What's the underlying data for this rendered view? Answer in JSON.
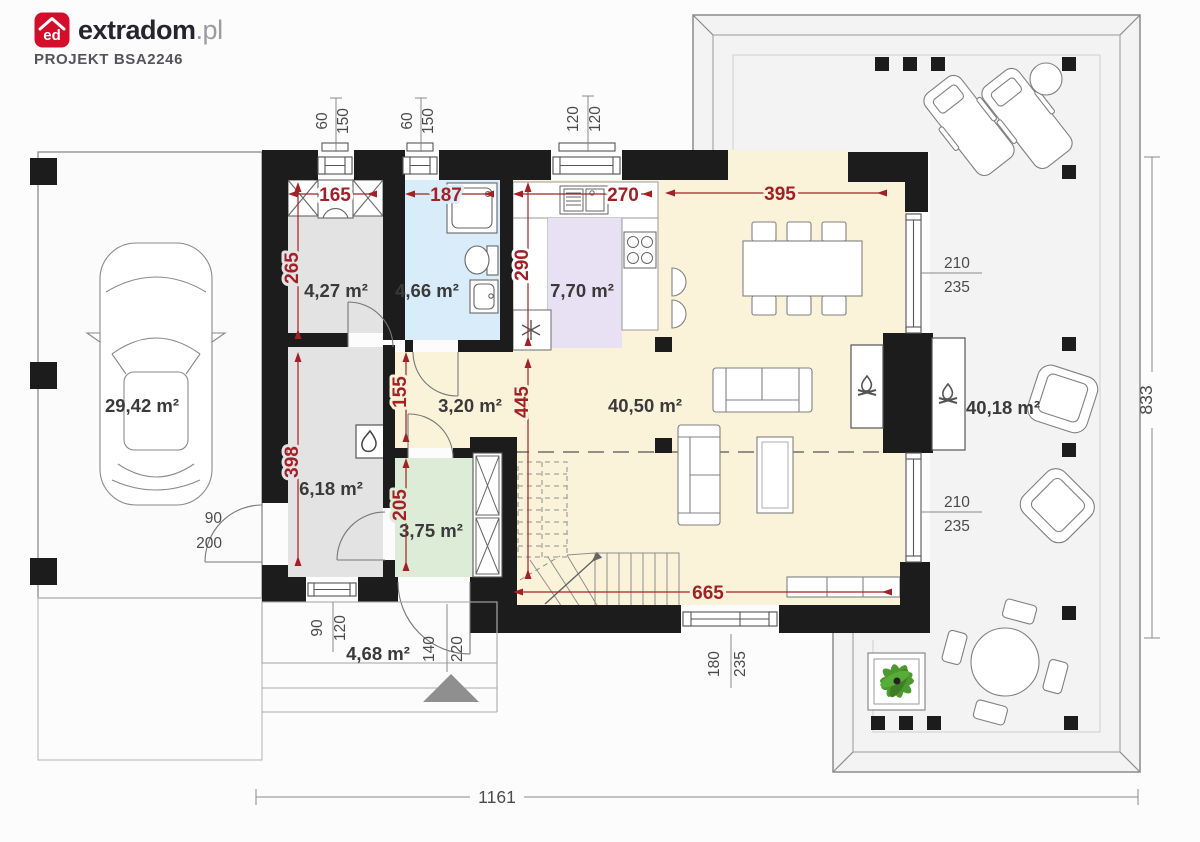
{
  "header": {
    "brand": "extradom",
    "suffix": ".pl",
    "monogram": "ed",
    "project": "PROJEKT BSA2246"
  },
  "rooms": {
    "garage": {
      "label": "29,42 m²"
    },
    "wardrobe": {
      "label": "4,27 m²"
    },
    "bathroom": {
      "label": "4,66 m²"
    },
    "kitchen": {
      "label": "7,70 m²"
    },
    "hall": {
      "label": "3,20 m²"
    },
    "living": {
      "label": "40,50 m²"
    },
    "utility": {
      "label": "6,18 m²"
    },
    "vestibule": {
      "label": "3,75 m²"
    },
    "porch": {
      "label": "4,68 m²"
    },
    "terrace": {
      "label": "40,18 m²"
    }
  },
  "dims": {
    "wardrobe_w": "165",
    "bathroom_w": "187",
    "kitchen_w": "270",
    "living_w": "395",
    "wardrobe_h": "265",
    "kitchen_h": "290",
    "hall_h": "155",
    "vestibule_h": "205",
    "utility_h": "398",
    "living_h": "445",
    "living_w2": "665"
  },
  "openings": {
    "top_win1": {
      "w": "60",
      "h": "150"
    },
    "top_win2": {
      "w": "60",
      "h": "150"
    },
    "top_win3": {
      "w": "120",
      "h": "120"
    },
    "right_win1": {
      "w": "210",
      "h": "235"
    },
    "right_win2": {
      "w": "210",
      "h": "235"
    },
    "garage_door": {
      "w": "90",
      "h": "200"
    },
    "porch_win": {
      "w": "90",
      "h": "120"
    },
    "entry_door": {
      "w": "140",
      "h": "220"
    },
    "bottom_win": {
      "w": "180",
      "h": "235"
    }
  },
  "overall": {
    "width": "1161",
    "depth": "833"
  },
  "colors": {
    "accent_red": "#a32126",
    "logo_red": "#d40d2b",
    "wall": "#1c1c1c",
    "floor_living": "#faf3da",
    "floor_gray": "#e3e3e3",
    "floor_bath": "#d9ecf9",
    "floor_kitchen": "#e8e1f4",
    "floor_vestibule": "#ddecd6",
    "plant_green": "#4c9a2f"
  }
}
